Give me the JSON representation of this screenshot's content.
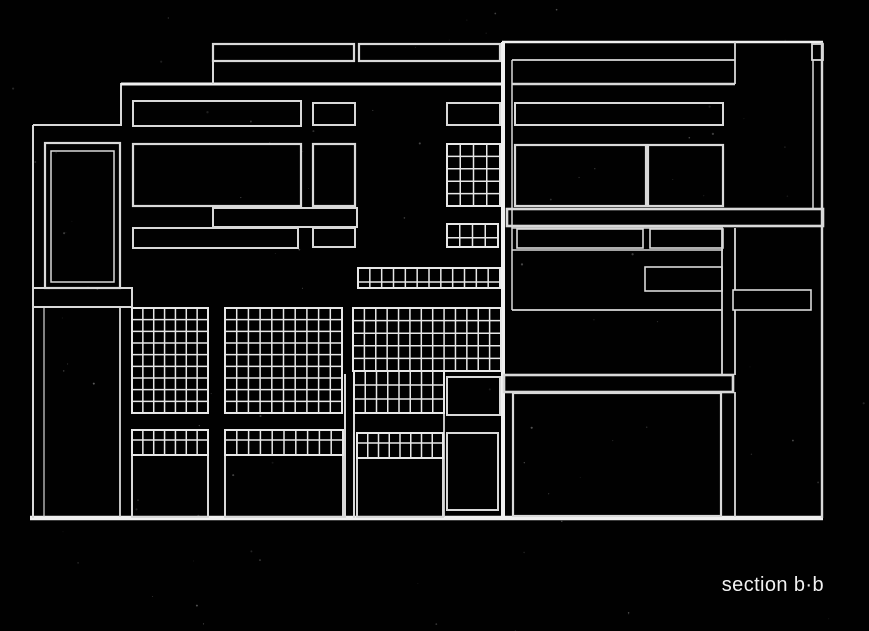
{
  "canvas": {
    "width": 869,
    "height": 631,
    "background": "#010101",
    "line_color": "#d9d9d9",
    "grid_color": "#e7e7e7",
    "bright_color": "#f0f0f0",
    "noise_color": "#aaaaaa"
  },
  "caption": {
    "text": "section b·b",
    "color": "#f2f2f2"
  },
  "drawing": {
    "rects": [
      {
        "name": "roof-parapet-left",
        "r": [
          213,
          44,
          141,
          17
        ],
        "sw": 2.2
      },
      {
        "name": "roof-parapet-mid",
        "r": [
          359,
          44,
          141,
          17
        ],
        "sw": 2.2
      },
      {
        "name": "roof-parapet-right-cap",
        "r": [
          812,
          44,
          11,
          16
        ],
        "sw": 1.8
      },
      {
        "name": "left-wing-window-outer",
        "r": [
          45,
          143,
          75,
          145
        ],
        "sw": 2.2
      },
      {
        "name": "left-wing-window-inner",
        "r": [
          51,
          151,
          63,
          131
        ],
        "sw": 1.5
      },
      {
        "name": "left-spandrel-bar",
        "r": [
          33,
          288,
          99,
          19
        ],
        "sw": 2
      },
      {
        "name": "upper-window-row1-left",
        "r": [
          133,
          101,
          168,
          25
        ],
        "sw": 2
      },
      {
        "name": "upper-window-row1-mid",
        "r": [
          313,
          103,
          42,
          22
        ],
        "sw": 2
      },
      {
        "name": "upper-window-row1-right",
        "r": [
          447,
          103,
          53,
          22
        ],
        "sw": 2
      },
      {
        "name": "upper-window-row2-left",
        "r": [
          133,
          144,
          168,
          62
        ],
        "sw": 2.2
      },
      {
        "name": "upper-window-row2-mid",
        "r": [
          313,
          144,
          42,
          62
        ],
        "sw": 2.2
      },
      {
        "name": "mid-floor-band",
        "r": [
          213,
          208,
          144,
          19
        ],
        "sw": 2
      },
      {
        "name": "upper-window-row3-left",
        "r": [
          133,
          228,
          165,
          20
        ],
        "sw": 2
      },
      {
        "name": "upper-window-row3-mid",
        "r": [
          313,
          228,
          42,
          19
        ],
        "sw": 2
      },
      {
        "name": "ground-room-1",
        "r": [
          132,
          455,
          76,
          62
        ],
        "sw": 2
      },
      {
        "name": "ground-room-2",
        "r": [
          225,
          455,
          118,
          62
        ],
        "sw": 2
      },
      {
        "name": "ground-room-3",
        "r": [
          357,
          458,
          86,
          59
        ],
        "sw": 2
      },
      {
        "name": "tower-window-square",
        "r": [
          447,
          377,
          53,
          38
        ],
        "sw": 2
      },
      {
        "name": "tower-door",
        "r": [
          447,
          433,
          51,
          77
        ],
        "sw": 2
      },
      {
        "name": "right-clerestory-band",
        "r": [
          515,
          103,
          208,
          22
        ],
        "sw": 2
      },
      {
        "name": "right-window-row2-left",
        "r": [
          515,
          145,
          131,
          61
        ],
        "sw": 2.2
      },
      {
        "name": "right-window-row2-right",
        "r": [
          648,
          145,
          75,
          61
        ],
        "sw": 2.2
      },
      {
        "name": "right-floor-slab-upper",
        "r": [
          507,
          209,
          316,
          17
        ],
        "sw": 2.6
      },
      {
        "name": "right-window-row3-left",
        "r": [
          517,
          229,
          126,
          19
        ],
        "sw": 1.6
      },
      {
        "name": "right-window-row3-right",
        "r": [
          650,
          229,
          73,
          19
        ],
        "sw": 1.6
      },
      {
        "name": "right-small-window",
        "r": [
          645,
          267,
          77,
          24
        ],
        "sw": 1.6
      },
      {
        "name": "right-column-block",
        "r": [
          733,
          290,
          78,
          20
        ],
        "sw": 1.6
      },
      {
        "name": "right-floor-slab-lower",
        "r": [
          504,
          375,
          229,
          17
        ],
        "sw": 2.6
      },
      {
        "name": "right-lower-room",
        "r": [
          513,
          393,
          208,
          123
        ],
        "sw": 2.2
      }
    ],
    "lines": [
      {
        "name": "ground-line",
        "p": [
          30,
          518,
          823,
          518
        ],
        "sw": 4.5,
        "bright": true
      },
      {
        "name": "left-wall-edge",
        "p": [
          33,
          125,
          33,
          518
        ],
        "sw": 2
      },
      {
        "name": "left-wing-top",
        "p": [
          33,
          125,
          120,
          125
        ],
        "sw": 2
      },
      {
        "name": "left-step-edge",
        "p": [
          121,
          83,
          121,
          126
        ],
        "sw": 2
      },
      {
        "name": "left-wall-inner",
        "p": [
          44,
          307,
          44,
          517
        ],
        "sw": 1.2
      },
      {
        "name": "left-wing-right-edge",
        "p": [
          120,
          307,
          120,
          517
        ],
        "sw": 1.8
      },
      {
        "name": "main-roof-edge",
        "p": [
          121,
          84,
          502,
          84
        ],
        "sw": 3,
        "bright": true
      },
      {
        "name": "upper-story-left-edge",
        "p": [
          213,
          44,
          213,
          84
        ],
        "sw": 2
      },
      {
        "name": "tower-party-wall",
        "p": [
          503,
          42,
          503,
          518
        ],
        "sw": 4,
        "bright": true
      },
      {
        "name": "right-roof-edge",
        "p": [
          502,
          42,
          823,
          42
        ],
        "sw": 2.6,
        "bright": true
      },
      {
        "name": "right-wall-inner-left",
        "p": [
          512,
          60,
          512,
          310
        ],
        "sw": 1.5
      },
      {
        "name": "right-parapet-bottom",
        "p": [
          512,
          60,
          735,
          60
        ],
        "sw": 1.8
      },
      {
        "name": "right-column-top",
        "p": [
          735,
          42,
          735,
          84
        ],
        "sw": 1.8
      },
      {
        "name": "right-upper-floor-line",
        "p": [
          512,
          84,
          735,
          84
        ],
        "sw": 2.4
      },
      {
        "name": "right-wall-inner-right",
        "p": [
          813,
          60,
          813,
          209
        ],
        "sw": 1.5
      },
      {
        "name": "right-wall-edge",
        "p": [
          822,
          42,
          822,
          518
        ],
        "sw": 2.4
      },
      {
        "name": "right-row3-top-line",
        "p": [
          512,
          228,
          723,
          228
        ],
        "sw": 1.4
      },
      {
        "name": "right-row3-bottom-line",
        "p": [
          512,
          250,
          723,
          250
        ],
        "sw": 1.4
      },
      {
        "name": "right-terrace-line",
        "p": [
          512,
          310,
          722,
          310
        ],
        "sw": 1.8
      },
      {
        "name": "right-column-left-upper",
        "p": [
          722,
          228,
          722,
          375
        ],
        "sw": 1.8
      },
      {
        "name": "right-column-right-upper",
        "p": [
          735,
          228,
          735,
          290
        ],
        "sw": 1.8
      },
      {
        "name": "right-column-right-mid",
        "p": [
          735,
          310,
          735,
          375
        ],
        "sw": 1.8
      },
      {
        "name": "right-column-right-lower",
        "p": [
          735,
          392,
          735,
          517
        ],
        "sw": 1.8
      },
      {
        "name": "chimney-left-edge",
        "p": [
          345,
          374,
          345,
          518
        ],
        "sw": 2
      },
      {
        "name": "chimney-right-edge",
        "p": [
          354,
          374,
          354,
          518
        ],
        "sw": 2
      },
      {
        "name": "tower-bay-divider",
        "p": [
          444,
          374,
          444,
          517
        ],
        "sw": 1.8
      }
    ],
    "grids": [
      {
        "name": "curtain-grid-1",
        "r": [
          132,
          308,
          76,
          105
        ],
        "cols": 7,
        "rows": 9
      },
      {
        "name": "curtain-grid-2",
        "r": [
          225,
          308,
          117,
          105
        ],
        "cols": 10,
        "rows": 9
      },
      {
        "name": "curtain-grid-3-upper",
        "r": [
          353,
          308,
          148,
          63
        ],
        "cols": 13,
        "rows": 5
      },
      {
        "name": "curtain-grid-3-lower",
        "r": [
          354,
          371,
          90,
          42
        ],
        "cols": 8,
        "rows": 3
      },
      {
        "name": "upper-grid-window",
        "r": [
          447,
          144,
          53,
          62
        ],
        "cols": 4,
        "rows": 5
      },
      {
        "name": "upper-grid-small",
        "r": [
          447,
          224,
          51,
          23
        ],
        "cols": 4,
        "rows": 2,
        "row_splits": [
          0.6
        ]
      },
      {
        "name": "mid-grid-strip",
        "r": [
          358,
          268,
          142,
          20
        ],
        "cols": 12,
        "rows": 2,
        "row_splits": [
          0.7
        ]
      },
      {
        "name": "transom-strip-1",
        "r": [
          132,
          430,
          76,
          25
        ],
        "cols": 7,
        "rows": 2,
        "row_splits": [
          0.4
        ]
      },
      {
        "name": "transom-strip-2",
        "r": [
          225,
          430,
          118,
          25
        ],
        "cols": 10,
        "rows": 2,
        "row_splits": [
          0.4
        ]
      },
      {
        "name": "transom-strip-3",
        "r": [
          357,
          433,
          86,
          25
        ],
        "cols": 8,
        "rows": 2,
        "row_splits": [
          0.4
        ]
      }
    ],
    "grain": {
      "count": 90
    }
  }
}
